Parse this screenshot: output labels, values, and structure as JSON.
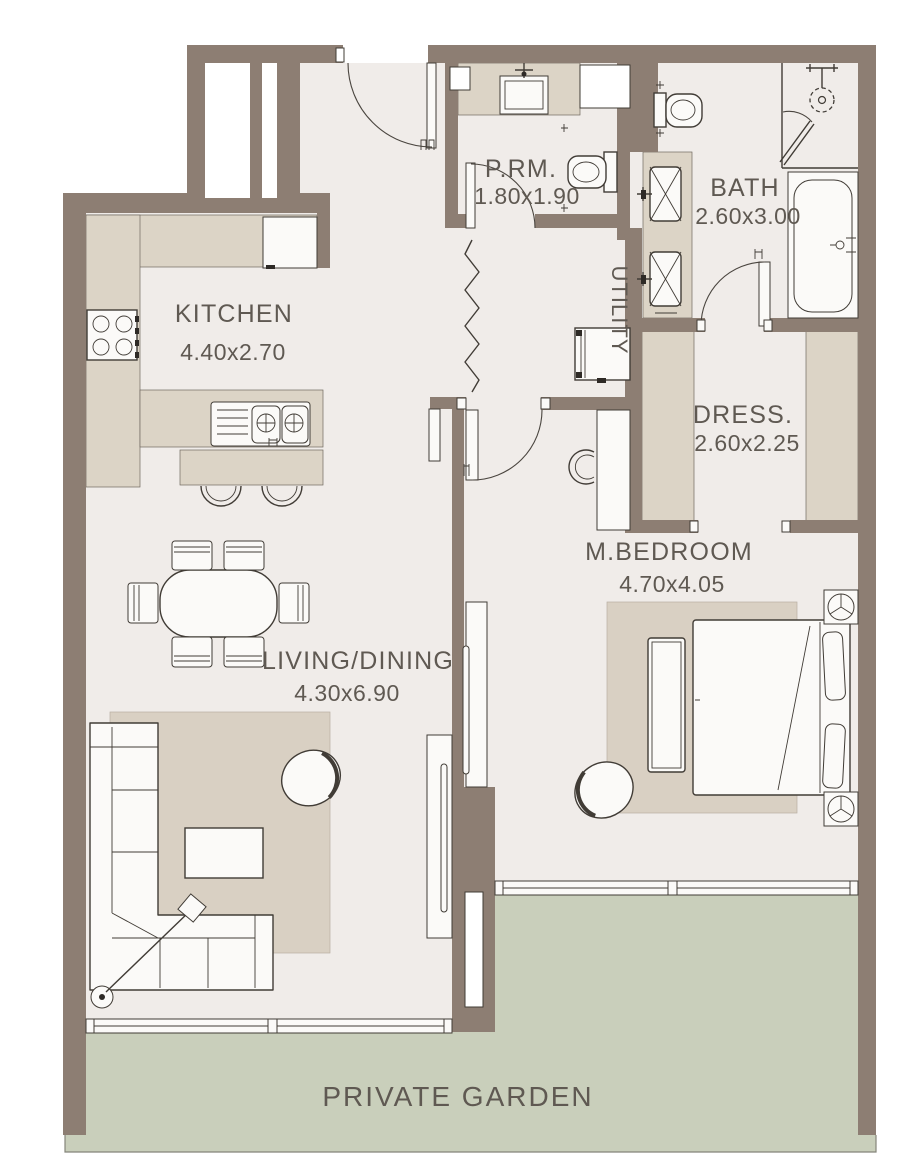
{
  "floor_plan": {
    "type": "apartment-floor-plan",
    "rooms": {
      "kitchen": {
        "name": "KITCHEN",
        "dims": "4.40x2.70"
      },
      "powder_room": {
        "name": "P.RM.",
        "dims": "1.80x1.90"
      },
      "bath": {
        "name": "BATH",
        "dims": "2.60x3.00"
      },
      "utility": {
        "name": "UTILITY",
        "dims": ""
      },
      "dress": {
        "name": "DRESS.",
        "dims": "2.60x2.25"
      },
      "master_bedroom": {
        "name": "M.BEDROOM",
        "dims": "4.70x4.05"
      },
      "living_dining": {
        "name": "LIVING/DINING",
        "dims": "4.30x6.90"
      },
      "private_garden": {
        "name": "PRIVATE GARDEN",
        "dims": ""
      }
    },
    "colors": {
      "wall": "#8d7e73",
      "floor": "#f0ece9",
      "millwork": "#dcd4c6",
      "garden": "#c9cfbb",
      "outline": "#413c36",
      "label": "#5f5952"
    }
  }
}
